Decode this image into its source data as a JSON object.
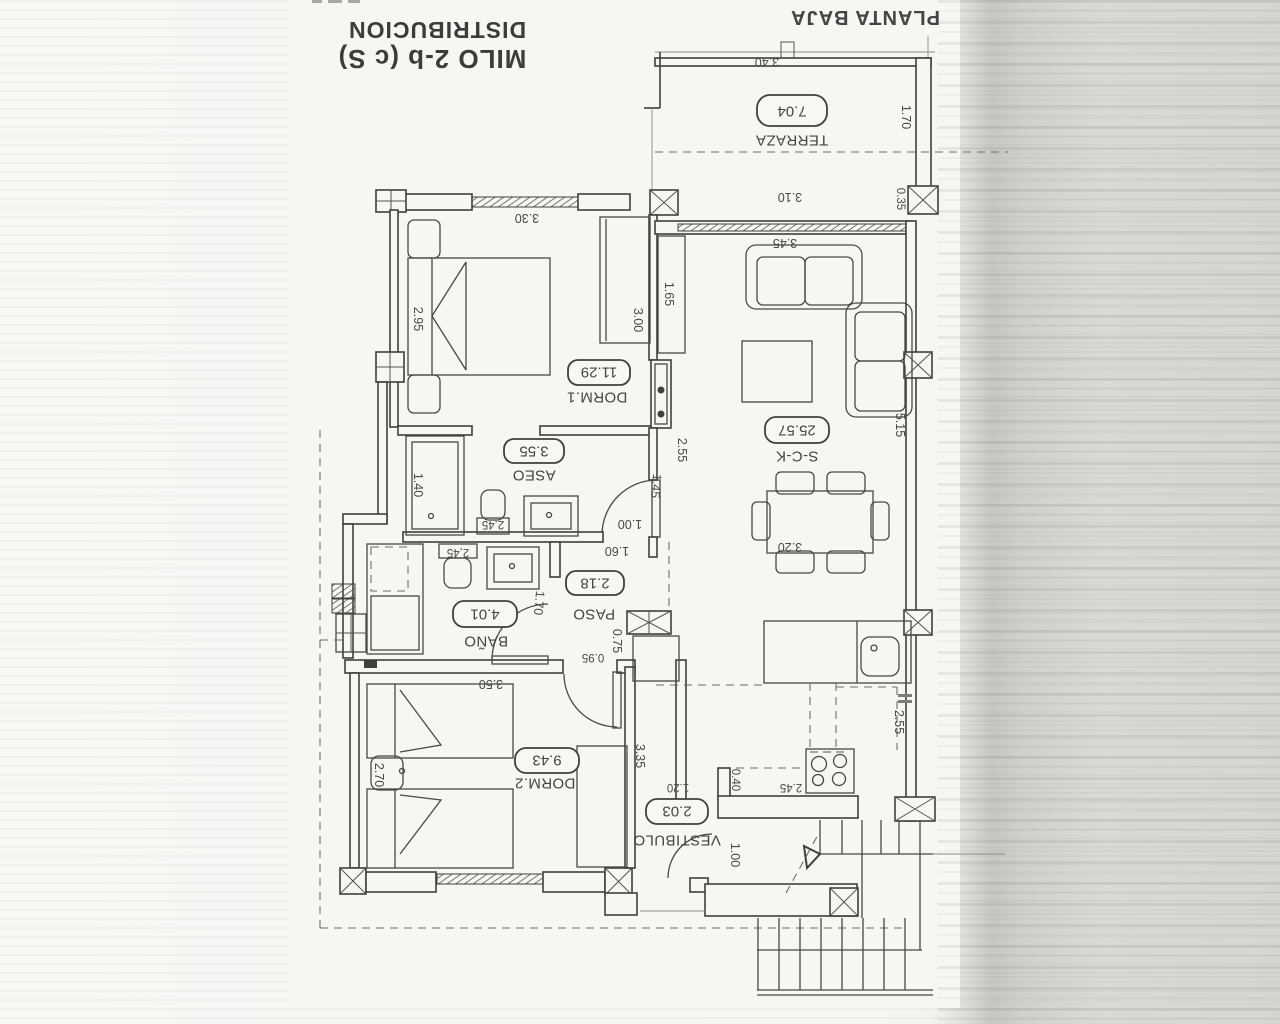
{
  "header": {
    "distribution_label": "DISTRIBUCION",
    "model_label": "MILO 2-b (c S)",
    "floor_label": "PLANTA BAJA"
  },
  "rooms": {
    "terraza": {
      "name": "TERRAZA",
      "area": "7.04"
    },
    "dorm1": {
      "name": "DORM.1",
      "area": "11.29"
    },
    "salon": {
      "name": "S-C-K",
      "area": "25.57"
    },
    "aseo": {
      "name": "ASEO",
      "area": "3.55"
    },
    "paso": {
      "name": "PASO",
      "area": "2.18"
    },
    "bano": {
      "name": "BAÑO",
      "area": "4.01"
    },
    "dorm2": {
      "name": "DORM.2",
      "area": "9.43"
    },
    "vestibulo": {
      "name": "VESTIBULO",
      "area": "2.03"
    }
  },
  "dims": {
    "terraza_width": "3.40",
    "terraza_depth": "1.70",
    "terraza_pillar": "0.35",
    "terraza_opening": "3.10",
    "salon_window_wall": "3.45",
    "salon_cabinet": "1.65",
    "salon_length": "5.15",
    "salon_door_wall": "2.55",
    "salon_door": "1.45",
    "salon_door_opening": "1.00",
    "dining_table": "3.20",
    "dorm1_window_wall": "3.30",
    "dorm1_width": "2.95",
    "dorm1_wardrobe": "3.00",
    "aseo_shower": "1.40",
    "aseo_toilet": "2,45",
    "paso_width": "1.60",
    "paso_depth": "0.75",
    "paso_opening": "0.95",
    "bano_toilet": "2,45",
    "bano_door": "1.70",
    "dorm2_window_wall": "3.50",
    "dorm2_nightstand": "2.70",
    "dorm2_depth": "3.35",
    "kitchen_stove": "2.45",
    "kitchen_step": "0.40",
    "kitchen_counter": "2.55",
    "vestibulo_width": "1.20",
    "entrance_door": "1.00"
  }
}
